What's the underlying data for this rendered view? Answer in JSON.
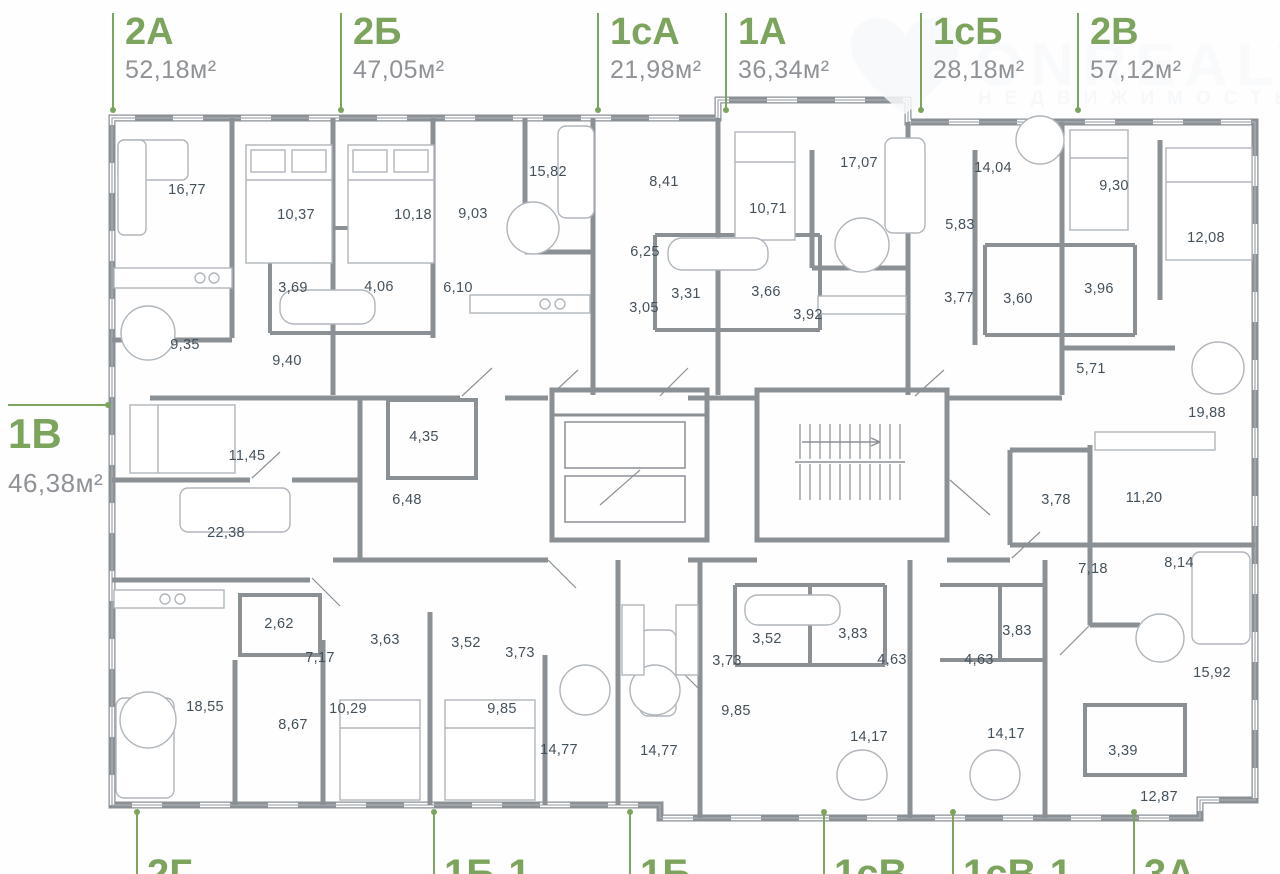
{
  "colors": {
    "accent_green": "#7da45c",
    "wall_gray": "#8b9095",
    "room_text": "#44515b",
    "area_text": "#8f9296"
  },
  "watermark": {
    "brand": "ONREALT",
    "subtitle": "НЕДВИЖИМОСТЬ"
  },
  "apartments": {
    "top": [
      {
        "code": "2А",
        "area": "52,18м²",
        "x": 112
      },
      {
        "code": "2Б",
        "area": "47,05м²",
        "x": 340
      },
      {
        "code": "1сА",
        "area": "21,98м²",
        "x": 597
      },
      {
        "code": "1А",
        "area": "36,34м²",
        "x": 725
      },
      {
        "code": "1сБ",
        "area": "28,18м²",
        "x": 920
      },
      {
        "code": "2В",
        "area": "57,12м²",
        "x": 1077
      }
    ],
    "left_label": {
      "code": "1В",
      "area": "46,38м²"
    },
    "bottom": [
      {
        "code": "2Г",
        "x": 136
      },
      {
        "code": "1Б-1",
        "x": 433
      },
      {
        "code": "1Б",
        "x": 629
      },
      {
        "code": "1сВ",
        "x": 823
      },
      {
        "code": "1сВ-1",
        "x": 952
      },
      {
        "code": "3А",
        "x": 1133
      }
    ]
  },
  "rooms": [
    {
      "v": "16,77",
      "x": 187,
      "y": 190
    },
    {
      "v": "10,37",
      "x": 296,
      "y": 215
    },
    {
      "v": "10,18",
      "x": 413,
      "y": 215
    },
    {
      "v": "9,03",
      "x": 473,
      "y": 214
    },
    {
      "v": "15,82",
      "x": 548,
      "y": 172
    },
    {
      "v": "3,69",
      "x": 293,
      "y": 288
    },
    {
      "v": "4,06",
      "x": 379,
      "y": 287
    },
    {
      "v": "6,10",
      "x": 458,
      "y": 288
    },
    {
      "v": "9,35",
      "x": 185,
      "y": 345
    },
    {
      "v": "9,40",
      "x": 287,
      "y": 361
    },
    {
      "v": "8,41",
      "x": 664,
      "y": 182
    },
    {
      "v": "6,25",
      "x": 645,
      "y": 252
    },
    {
      "v": "3,05",
      "x": 644,
      "y": 308
    },
    {
      "v": "3,31",
      "x": 686,
      "y": 294
    },
    {
      "v": "3,66",
      "x": 766,
      "y": 292
    },
    {
      "v": "10,71",
      "x": 768,
      "y": 209
    },
    {
      "v": "3,92",
      "x": 808,
      "y": 315
    },
    {
      "v": "17,07",
      "x": 859,
      "y": 163
    },
    {
      "v": "14,04",
      "x": 993,
      "y": 168
    },
    {
      "v": "5,83",
      "x": 960,
      "y": 225
    },
    {
      "v": "3,77",
      "x": 959,
      "y": 298
    },
    {
      "v": "3,60",
      "x": 1018,
      "y": 299
    },
    {
      "v": "9,30",
      "x": 1114,
      "y": 186
    },
    {
      "v": "3,96",
      "x": 1099,
      "y": 289
    },
    {
      "v": "12,08",
      "x": 1206,
      "y": 238
    },
    {
      "v": "5,71",
      "x": 1091,
      "y": 369
    },
    {
      "v": "19,88",
      "x": 1207,
      "y": 413
    },
    {
      "v": "11,45",
      "x": 247,
      "y": 456
    },
    {
      "v": "4,35",
      "x": 424,
      "y": 437
    },
    {
      "v": "6,48",
      "x": 407,
      "y": 500
    },
    {
      "v": "22,38",
      "x": 226,
      "y": 533
    },
    {
      "v": "2,62",
      "x": 279,
      "y": 624
    },
    {
      "v": "7,17",
      "x": 320,
      "y": 658
    },
    {
      "v": "3,63",
      "x": 385,
      "y": 640
    },
    {
      "v": "3,52",
      "x": 466,
      "y": 643
    },
    {
      "v": "18,55",
      "x": 205,
      "y": 707
    },
    {
      "v": "8,67",
      "x": 293,
      "y": 725
    },
    {
      "v": "10,29",
      "x": 348,
      "y": 709
    },
    {
      "v": "9,85",
      "x": 502,
      "y": 709
    },
    {
      "v": "3,73",
      "x": 520,
      "y": 653
    },
    {
      "v": "14,77",
      "x": 559,
      "y": 750
    },
    {
      "v": "3,73",
      "x": 727,
      "y": 661
    },
    {
      "v": "3,52",
      "x": 767,
      "y": 639
    },
    {
      "v": "9,85",
      "x": 736,
      "y": 711
    },
    {
      "v": "14,77",
      "x": 659,
      "y": 751
    },
    {
      "v": "3,83",
      "x": 853,
      "y": 634
    },
    {
      "v": "4,63",
      "x": 892,
      "y": 660
    },
    {
      "v": "14,17",
      "x": 869,
      "y": 737
    },
    {
      "v": "4,63",
      "x": 979,
      "y": 660
    },
    {
      "v": "14,17",
      "x": 1006,
      "y": 734
    },
    {
      "v": "3,83",
      "x": 1017,
      "y": 631
    },
    {
      "v": "3,78",
      "x": 1056,
      "y": 500
    },
    {
      "v": "11,20",
      "x": 1144,
      "y": 498
    },
    {
      "v": "7,18",
      "x": 1093,
      "y": 569
    },
    {
      "v": "8,14",
      "x": 1179,
      "y": 563
    },
    {
      "v": "15,92",
      "x": 1212,
      "y": 673
    },
    {
      "v": "3,39",
      "x": 1123,
      "y": 751
    },
    {
      "v": "12,87",
      "x": 1159,
      "y": 797
    }
  ]
}
